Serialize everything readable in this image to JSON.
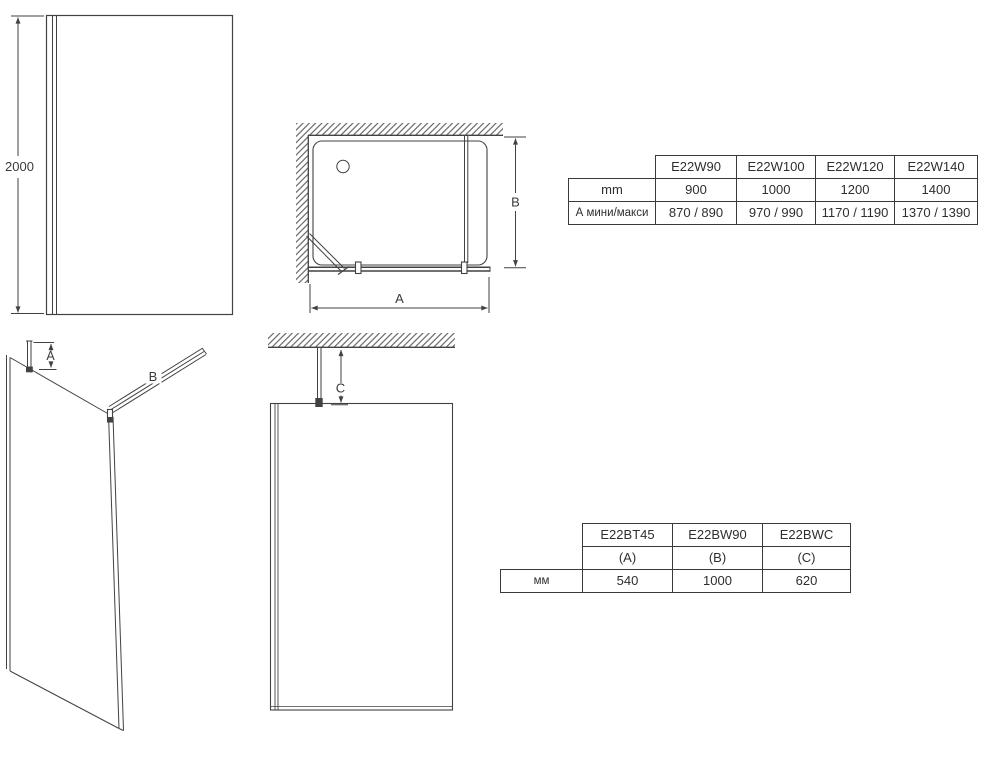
{
  "page": {
    "background": "#ffffff",
    "line_color": "#424242",
    "text_color": "#3a3a3a"
  },
  "front_view": {
    "height_dim": "2000"
  },
  "plan_view": {
    "width_dim": "A",
    "depth_dim": "B"
  },
  "iso_view": {
    "wall_profile_dim": "A",
    "support_bar_dim": "B"
  },
  "ceiling_view": {
    "ceiling_mount_dim": "C"
  },
  "width_table": {
    "columns": [
      "E22W90",
      "E22W100",
      "E22W120",
      "E22W140"
    ],
    "rows": [
      {
        "label": "mm",
        "values": [
          "900",
          "1000",
          "1200",
          "1400"
        ]
      },
      {
        "label": "А мини/макси",
        "values": [
          "870 / 890",
          "970 / 990",
          "1170 / 1190",
          "1370 / 1390"
        ]
      }
    ]
  },
  "support_table": {
    "columns": [
      "E22BT45",
      "E22BW90",
      "E22BWC"
    ],
    "sub_labels": [
      "(A)",
      "(B)",
      "(C)"
    ],
    "row_label": "мм",
    "values": [
      "540",
      "1000",
      "620"
    ]
  }
}
